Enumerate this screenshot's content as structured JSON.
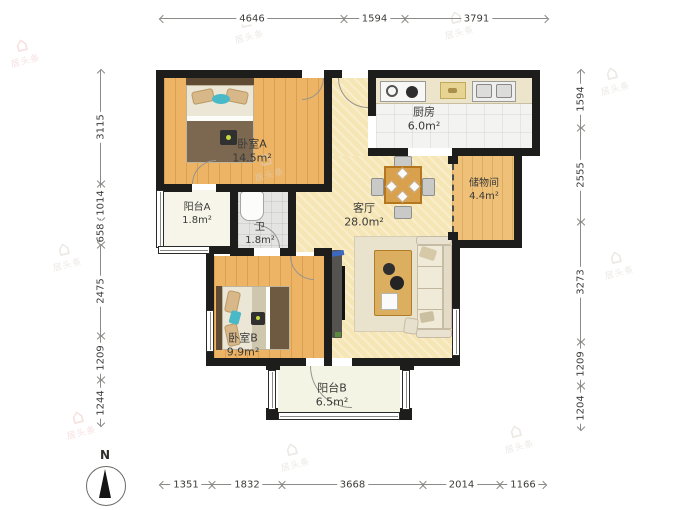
{
  "plan": {
    "rooms": {
      "bedroomA": {
        "name": "卧室A",
        "area": "14.5m²"
      },
      "kitchen": {
        "name": "厨房",
        "area": "6.0m²"
      },
      "storage": {
        "name": "储物间",
        "area": "4.4m²"
      },
      "living": {
        "name": "客厅",
        "area": "28.0m²"
      },
      "balconyA": {
        "name": "阳台A",
        "area": "1.8m²"
      },
      "bath": {
        "name": "卫",
        "area": "1.8m²"
      },
      "bedroomB": {
        "name": "卧室B",
        "area": "9.9m²"
      },
      "balconyB": {
        "name": "阳台B",
        "area": "6.5m²"
      }
    }
  },
  "dimensions": {
    "top": {
      "pos": 18,
      "segments": [
        {
          "label": "4646",
          "from": 160,
          "to": 344
        },
        {
          "label": "1594",
          "from": 344,
          "to": 405
        },
        {
          "label": "3791",
          "from": 405,
          "to": 548
        }
      ]
    },
    "bottom": {
      "pos": 484,
      "segments": [
        {
          "label": "1351",
          "from": 160,
          "to": 212
        },
        {
          "label": "1832",
          "from": 212,
          "to": 282
        },
        {
          "label": "3668",
          "from": 282,
          "to": 423
        },
        {
          "label": "2014",
          "from": 423,
          "to": 500
        },
        {
          "label": "1166",
          "from": 500,
          "to": 546
        }
      ]
    },
    "left": {
      "pos": 100,
      "segments": [
        {
          "label": "3115",
          "from": 70,
          "to": 184
        },
        {
          "label": "1014",
          "from": 184,
          "to": 221
        },
        {
          "label": "658",
          "from": 221,
          "to": 245
        },
        {
          "label": "2475",
          "from": 245,
          "to": 336
        },
        {
          "label": "1209",
          "from": 336,
          "to": 380
        },
        {
          "label": "1244",
          "from": 380,
          "to": 426
        }
      ]
    },
    "right": {
      "pos": 580,
      "segments": [
        {
          "label": "1594",
          "from": 70,
          "to": 128
        },
        {
          "label": "2555",
          "from": 128,
          "to": 222
        },
        {
          "label": "3273",
          "from": 222,
          "to": 342
        },
        {
          "label": "1209",
          "from": 342,
          "to": 386
        },
        {
          "label": "1204",
          "from": 386,
          "to": 430
        }
      ]
    }
  },
  "compass": {
    "label": "N"
  },
  "watermark": {
    "icon": "⌂",
    "text": "居头条",
    "positions": [
      {
        "x": 8,
        "y": 34,
        "pink": true
      },
      {
        "x": 232,
        "y": 10,
        "pink": false
      },
      {
        "x": 442,
        "y": 6,
        "pink": false
      },
      {
        "x": 598,
        "y": 62,
        "pink": false
      },
      {
        "x": 50,
        "y": 238,
        "pink": false
      },
      {
        "x": 602,
        "y": 246,
        "pink": false
      },
      {
        "x": 252,
        "y": 148,
        "pink": false
      },
      {
        "x": 420,
        "y": 288,
        "pink": false
      },
      {
        "x": 64,
        "y": 406,
        "pink": true
      },
      {
        "x": 502,
        "y": 420,
        "pink": false
      },
      {
        "x": 278,
        "y": 438,
        "pink": false
      }
    ]
  },
  "colors": {
    "wall": "#1d1d1b",
    "wood_floor": "#ecb464",
    "living_floor": "#f6e6b6",
    "accent_teal": "#49b9c7"
  }
}
